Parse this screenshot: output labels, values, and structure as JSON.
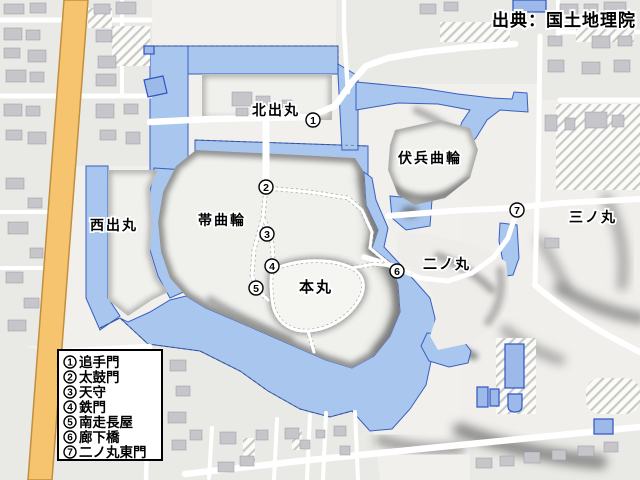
{
  "attribution": "出典：国土地理院",
  "map": {
    "colors": {
      "water": "#a9c6ef",
      "water_outline": "#3a5fc0",
      "main_road": "#f6c46f",
      "main_road_outline": "#c28f3e",
      "highlight_building": "#9db9ea",
      "highlight_building_outline": "#2f55c2"
    },
    "labels": {
      "kitademaru": "北出丸",
      "nishidemaru": "西出丸",
      "obikuruwa": "帯曲輪",
      "honmaru": "本丸",
      "fukuheikuruwa": "伏兵曲輪",
      "ninomaru": "二ノ丸",
      "sannomaru": "三ノ丸"
    },
    "markers": [
      {
        "num": "1"
      },
      {
        "num": "2"
      },
      {
        "num": "3"
      },
      {
        "num": "4"
      },
      {
        "num": "5"
      },
      {
        "num": "6"
      },
      {
        "num": "7"
      }
    ],
    "legend": {
      "items": [
        {
          "num": "1",
          "name": "追手門"
        },
        {
          "num": "2",
          "name": "太鼓門"
        },
        {
          "num": "3",
          "name": "天守"
        },
        {
          "num": "4",
          "name": "鉄門"
        },
        {
          "num": "5",
          "name": "南走長屋"
        },
        {
          "num": "6",
          "name": "廊下橋"
        },
        {
          "num": "7",
          "name": "二ノ丸東門"
        }
      ]
    }
  }
}
